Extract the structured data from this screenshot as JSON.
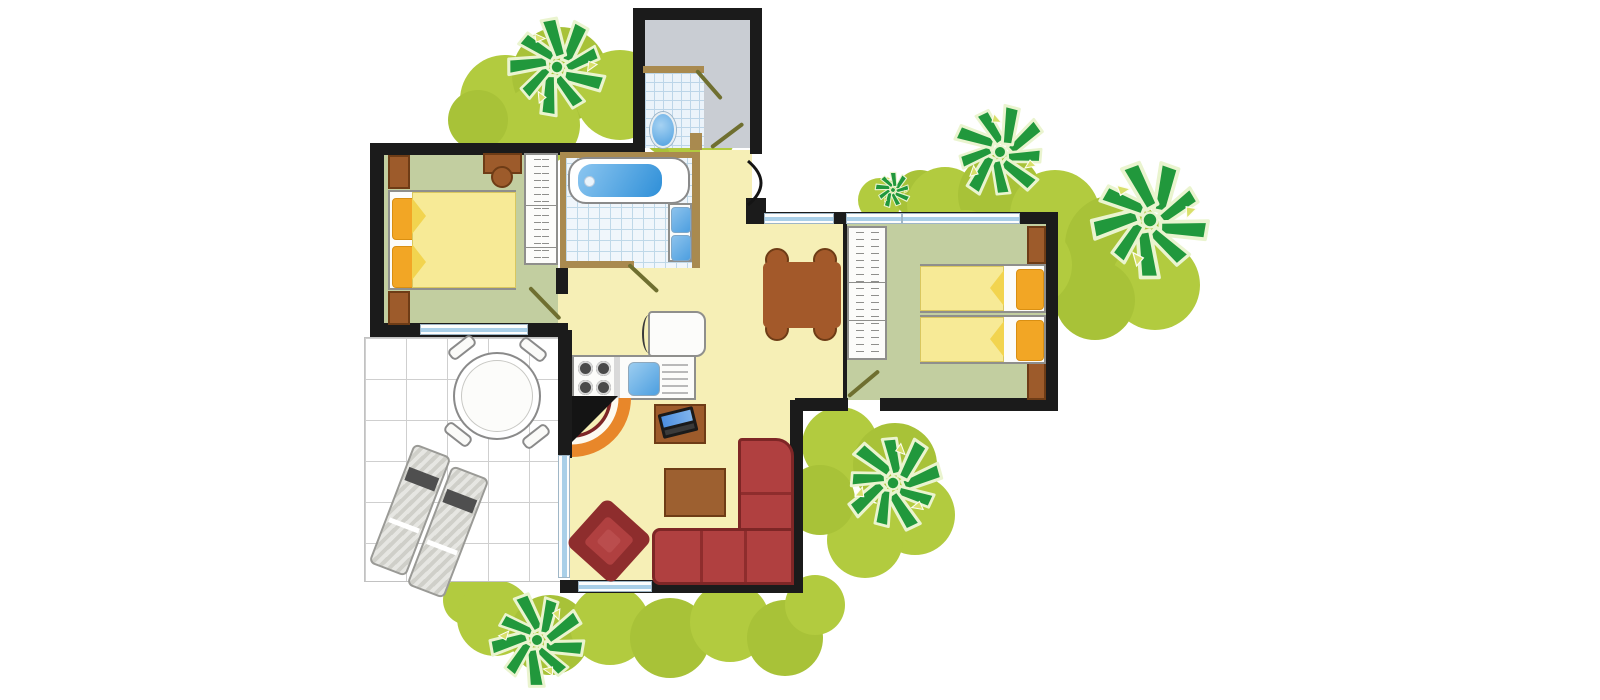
{
  "meta": {
    "title": "Bungalow floor plan, top view",
    "kind": "architectural floor plan illustration"
  },
  "palette": {
    "wall_black": "#1B1B1B",
    "partition_brown": "#A98A4F",
    "bedroom_floor_green": "#C2CEA0",
    "living_floor_yellow": "#F6EFB6",
    "entry_floor_gray": "#C9CDD3",
    "terrace_white": "#FFFFFF",
    "tile_blue_line": "#BFD8E8",
    "window_blue": "#A9CFE8",
    "wood_brown": "#9D5B2B",
    "table_brown": "#A3592A",
    "bed_blanket_yellow": "#F7EA96",
    "pillow_orange": "#F2A625",
    "sofa_red": "#B04040",
    "sofa_border_red": "#7E2626",
    "water_blue": "#58A7E6",
    "fireplace_orange": "#E8872A",
    "tree_green": "#21983C",
    "bush_green": "#B2CB3F"
  },
  "rooms": [
    {
      "id": "bedroom-1",
      "label": "Double bedroom (left), green floor"
    },
    {
      "id": "bedroom-2",
      "label": "Twin bedroom (right), green floor"
    },
    {
      "id": "bathroom",
      "label": "Bathroom with bathtub and two wash basins, tiled floor"
    },
    {
      "id": "wc",
      "label": "Separate WC with toilet, tiled cubicle in gray entry room"
    },
    {
      "id": "living-room",
      "label": "Living room / kitchen, yellow floor"
    },
    {
      "id": "terrace",
      "label": "Tiled terrace with dining set and sun loungers"
    }
  ],
  "furniture": [
    "double-bed with two orange pillows",
    "two nightstands",
    "bedroom chair",
    "wardrobes with shelves",
    "bathtub",
    "two wash basins",
    "toilet",
    "fridge",
    "kitchen counter with 4-burner hob and sink with drainer",
    "corner fireplace with orange hearth arc",
    "desk with laptop",
    "dining table with four chairs",
    "coffee table",
    "red corner sofa",
    "red armchair",
    "two twin beds with orange pillows",
    "round terrace table with four chairs",
    "two sun loungers"
  ],
  "vegetation": {
    "palm_trees": 6,
    "bush_clusters": 4
  },
  "openings": {
    "windows": 6,
    "interior_doors": 5,
    "entrance_doors": 1,
    "terrace_glass_door": 1
  }
}
